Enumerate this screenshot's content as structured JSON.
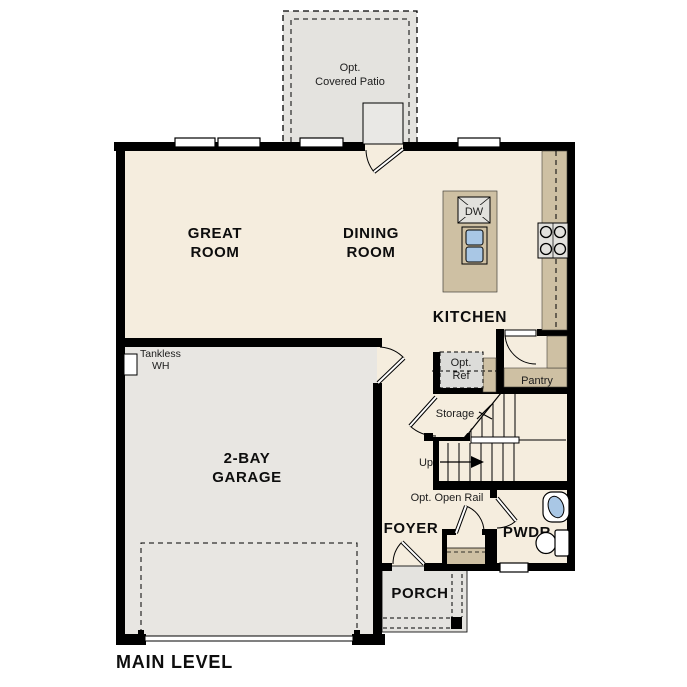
{
  "title": "MAIN LEVEL",
  "plan": {
    "rooms": {
      "great_room": {
        "label": [
          "GREAT",
          "ROOM"
        ]
      },
      "dining_room": {
        "label": [
          "DINING",
          "ROOM"
        ]
      },
      "kitchen": {
        "label": "KITCHEN"
      },
      "garage": {
        "label": [
          "2-BAY",
          "GARAGE"
        ]
      },
      "foyer": {
        "label": "FOYER"
      },
      "powder_room": {
        "label": "PWDR"
      },
      "porch": {
        "label": "PORCH"
      },
      "pantry": {
        "label": "Pantry"
      },
      "storage": {
        "label": "Storage"
      },
      "covered_patio": {
        "label": [
          "Opt.",
          "Covered Patio"
        ]
      }
    },
    "features": {
      "tankless_wh": {
        "label": [
          "Tankless",
          "WH"
        ]
      },
      "opt_ref": {
        "label": [
          "Opt.",
          "Ref"
        ]
      },
      "dishwasher": {
        "label": "DW"
      },
      "stairs": {
        "direction_label": "Up",
        "rail_label": "Opt. Open Rail"
      }
    },
    "colors": {
      "floor": "#f5edde",
      "garage_floor": "#e8e6e2",
      "outdoor_concrete": "#e4e3df",
      "casework_tan": "#cec0a3",
      "appliance_gray": "#e2e1dd",
      "sink_blue": "#a9c7e5",
      "wall": "#000000"
    }
  }
}
